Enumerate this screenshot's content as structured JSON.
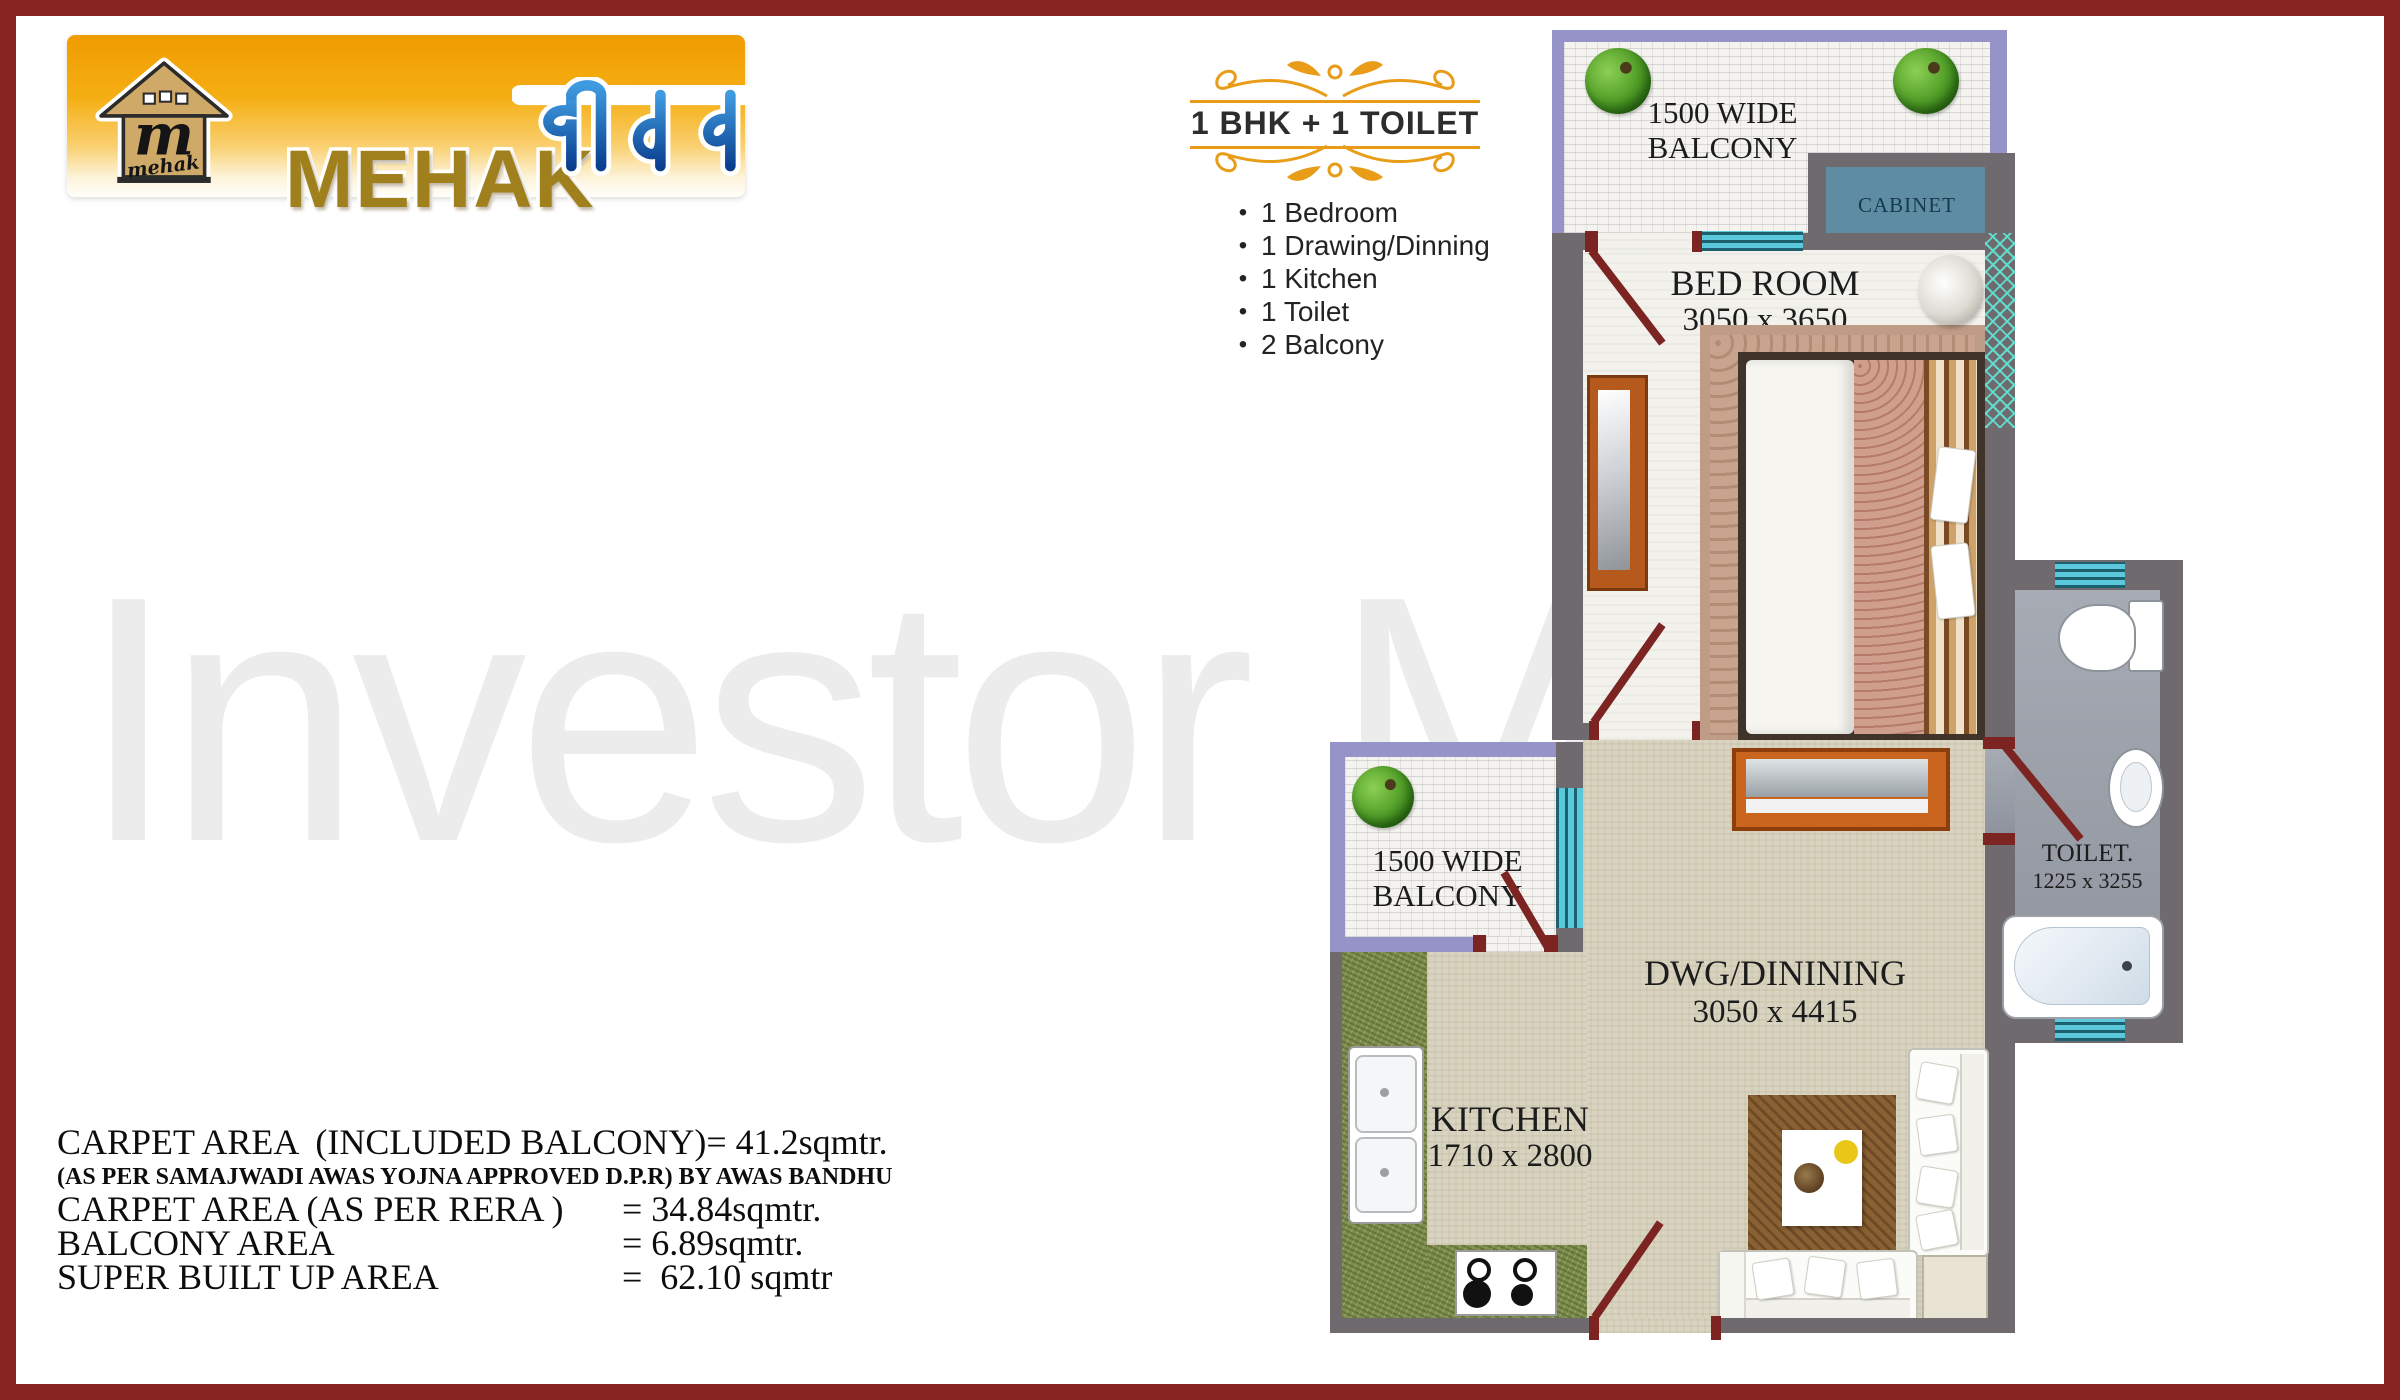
{
  "page": {
    "border_color": "#862521",
    "background": "#ffffff"
  },
  "watermark": {
    "text": "Investor Mart",
    "color": "#ececec"
  },
  "logo": {
    "brand": "MEHAK",
    "brand_hindi": "जीवन",
    "emblem_monogram": "m",
    "emblem_script": "mehak",
    "brand_color": "#a0801c",
    "hindi_color_top": "#3f9be0",
    "hindi_color_bottom": "#0a3f8f",
    "banner_gradient_top": "#ef9c01",
    "banner_gradient_bottom": "#fffefa"
  },
  "unit_header": {
    "title": "1 BHK + 1 TOILET",
    "flourish_color": "#e89c17"
  },
  "features": {
    "bullet_char": "•",
    "items": [
      "1 Bedroom",
      "1 Drawing/Dinning",
      "1 Kitchen",
      "1 Toilet",
      "2 Balcony"
    ]
  },
  "areas": {
    "lines": [
      {
        "label": "CARPET AREA  (INCLUDED BALCONY)",
        "value": "= 41.2sqmtr."
      },
      {
        "label": "(AS PER SAMAJWADI AWAS YOJNA APPROVED D.P.R) BY AWAS BANDHU",
        "value": ""
      },
      {
        "label": "CARPET AREA (AS PER RERA )",
        "value": "= 34.84sqmtr."
      },
      {
        "label": "BALCONY AREA",
        "value": "= 6.89sqmtr."
      },
      {
        "label": "SUPER BUILT UP AREA",
        "value": "=  62.10 sqmtr"
      }
    ]
  },
  "floor_plan": {
    "rooms": {
      "balcony_top": {
        "line1": "1500 WIDE",
        "line2": "BALCONY"
      },
      "balcony_mid": {
        "line1": "1500 WIDE",
        "line2": "BALCONY"
      },
      "cabinet": {
        "label": "CABINET"
      },
      "bedroom": {
        "name": "BED ROOM",
        "dims": "3050 x 3650"
      },
      "toilet": {
        "name": "TOILET.",
        "dims": "1225 x 3255"
      },
      "drawing_dining": {
        "name": "DWG/DININING",
        "dims": "3050 x 4415"
      },
      "kitchen": {
        "name": "KITCHEN",
        "dims": "1710 x 2800"
      }
    },
    "colors": {
      "wall": "#6f6a6d",
      "balcony_frame": "#9693c8",
      "window": "#5bc8dc",
      "door": "#7c2422",
      "mesh": "#49c8b8",
      "floor_beige": "#d9d4c1",
      "floor_light": "#f2f1ec",
      "toilet_floor": "#9aa0a8",
      "kitchen_counter_green": "#7e8c4d",
      "cabinet_teal": "#5e8ca3"
    }
  }
}
